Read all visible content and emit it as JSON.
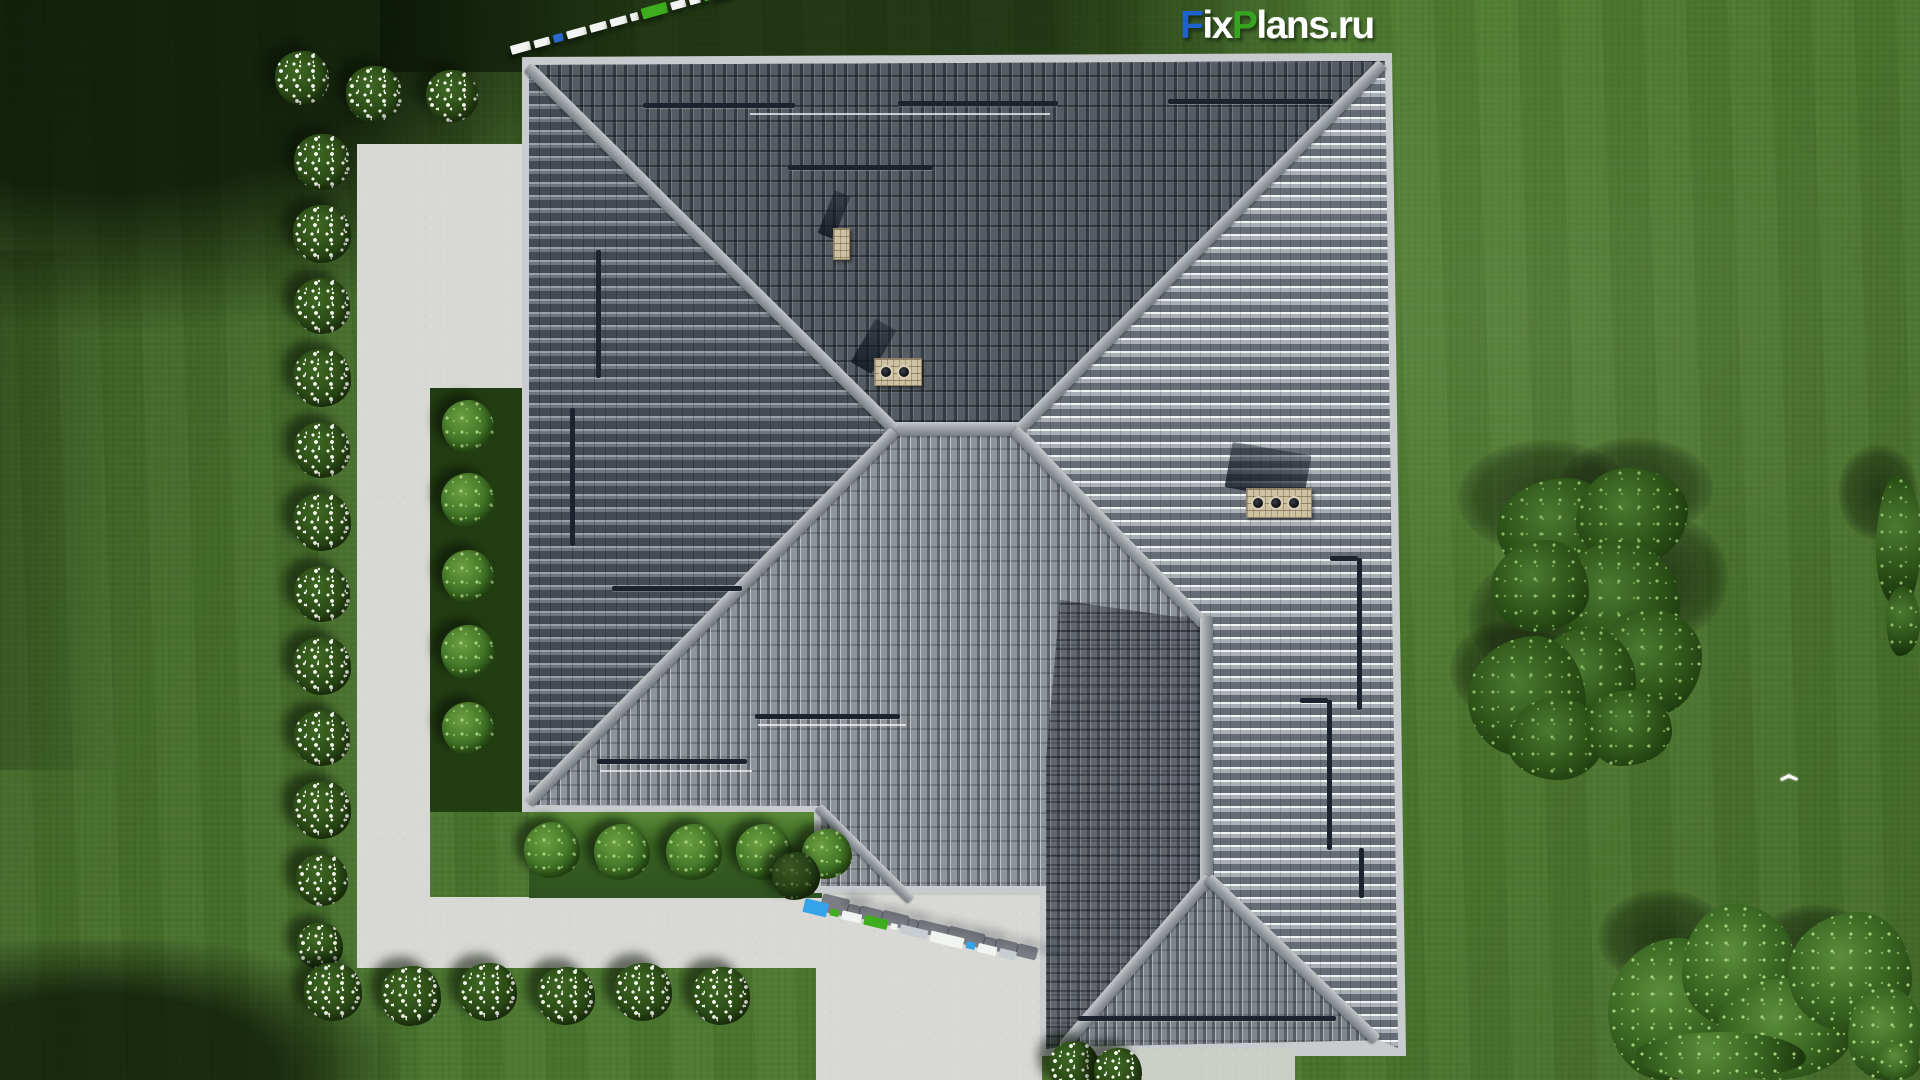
{
  "watermark": {
    "parts": [
      {
        "text": "F",
        "color": "#1e62d0"
      },
      {
        "text": "ix",
        "color": "#ffffff"
      },
      {
        "text": "P",
        "color": "#35a421"
      },
      {
        "text": "lans",
        "color": "#ffffff"
      },
      {
        "text": ".ru",
        "color": "#ffffff"
      }
    ]
  },
  "palette": {
    "grass": "#4a762d",
    "grass_shadow": "#1c350f",
    "concrete": "#d8d8d4",
    "roof_dark": "#40464e",
    "roof_light": "#9aa0a7",
    "ridge": "#a7abaf",
    "brick": "#cfc2a2",
    "accent_blue": "#2a6ad0",
    "accent_cyan": "#35a3e8",
    "accent_green": "#3fae1e",
    "flower_white": "#f6f8f0"
  },
  "garden": {
    "flower_bushes": [
      [
        302,
        78,
        54
      ],
      [
        374,
        94,
        56
      ],
      [
        452,
        96,
        52
      ],
      [
        322,
        162,
        56
      ],
      [
        322,
        234,
        58
      ],
      [
        322,
        306,
        56
      ],
      [
        322,
        378,
        58
      ],
      [
        322,
        450,
        56
      ],
      [
        322,
        522,
        58
      ],
      [
        322,
        594,
        56
      ],
      [
        322,
        666,
        58
      ],
      [
        322,
        738,
        56
      ],
      [
        322,
        810,
        58
      ],
      [
        322,
        880,
        52
      ],
      [
        320,
        946,
        46
      ],
      [
        333,
        992,
        58
      ],
      [
        411,
        996,
        60
      ],
      [
        488,
        992,
        58
      ],
      [
        566,
        996,
        58
      ],
      [
        643,
        992,
        58
      ],
      [
        721,
        996,
        58
      ],
      [
        1074,
        1066,
        50
      ],
      [
        1118,
        1072,
        48
      ]
    ],
    "green_bushes": [
      [
        468,
        426,
        52,
        0
      ],
      [
        468,
        500,
        54,
        0
      ],
      [
        468,
        576,
        52,
        0
      ],
      [
        468,
        652,
        54,
        0
      ],
      [
        468,
        728,
        52,
        0
      ],
      [
        552,
        850,
        56,
        0
      ],
      [
        622,
        852,
        56,
        0
      ],
      [
        694,
        852,
        56,
        0
      ],
      [
        764,
        852,
        56,
        0
      ],
      [
        827,
        854,
        50,
        0
      ],
      [
        796,
        876,
        48,
        1
      ]
    ]
  },
  "trees": {
    "shadows": [
      [
        1458,
        440,
        175,
        115
      ],
      [
        1558,
        438,
        155,
        100
      ],
      [
        1468,
        555,
        150,
        125
      ],
      [
        1598,
        515,
        130,
        125
      ],
      [
        1450,
        620,
        120,
        100
      ],
      [
        1598,
        890,
        130,
        95
      ],
      [
        1755,
        905,
        120,
        85
      ],
      [
        1640,
        935,
        130,
        80
      ],
      [
        1838,
        445,
        80,
        95
      ]
    ],
    "canopies": [
      [
        1497,
        478,
        122,
        100,
        0
      ],
      [
        1576,
        468,
        112,
        96,
        0
      ],
      [
        1556,
        542,
        124,
        118,
        0
      ],
      [
        1491,
        540,
        98,
        92,
        0
      ],
      [
        1598,
        608,
        104,
        108,
        0
      ],
      [
        1538,
        628,
        98,
        98,
        0
      ],
      [
        1468,
        636,
        118,
        120,
        0
      ],
      [
        1508,
        698,
        98,
        82,
        0
      ],
      [
        1586,
        690,
        86,
        76,
        0
      ],
      [
        1608,
        938,
        124,
        142,
        1
      ],
      [
        1682,
        904,
        112,
        124,
        1
      ],
      [
        1718,
        978,
        134,
        102,
        1
      ],
      [
        1788,
        912,
        124,
        118,
        1
      ],
      [
        1848,
        986,
        74,
        94,
        1
      ],
      [
        1636,
        1032,
        170,
        48,
        1
      ],
      [
        1876,
        1040,
        44,
        40,
        1
      ],
      [
        1876,
        476,
        46,
        132,
        0
      ],
      [
        1886,
        586,
        34,
        70,
        0
      ]
    ]
  },
  "strips": [
    {
      "x": 511,
      "y": 44,
      "angle": -15.5,
      "gap": 4,
      "cls": "strip1",
      "pieces": [
        [
          "w",
          20,
          9
        ],
        [
          "w",
          16,
          8
        ],
        [
          "b",
          10,
          8
        ],
        [
          "w",
          20,
          8
        ],
        [
          "w",
          17,
          8
        ],
        [
          "w",
          17,
          8
        ],
        [
          "w",
          8,
          8
        ],
        [
          "g",
          26,
          11
        ],
        [
          "w",
          15,
          8
        ],
        [
          "w",
          11,
          8
        ],
        [
          "g",
          7,
          8
        ],
        [
          "b",
          20,
          13
        ]
      ]
    },
    {
      "x": 804,
      "y": 898,
      "angle": 13.5,
      "gap": 3,
      "cls": "strip2",
      "pieces": [
        [
          "c",
          24,
          14
        ],
        [
          "g",
          9,
          7
        ],
        [
          "w",
          20,
          9
        ],
        [
          "g",
          24,
          10
        ],
        [
          "w",
          7,
          6
        ],
        [
          "wd",
          28,
          9
        ],
        [
          "w",
          34,
          11
        ],
        [
          "c",
          9,
          7
        ],
        [
          "w",
          19,
          9
        ],
        [
          "wd",
          17,
          9
        ]
      ]
    }
  ],
  "roof": {
    "snow_bars_h": [
      [
        643,
        103,
        152
      ],
      [
        898,
        101,
        160
      ],
      [
        1168,
        99,
        165
      ],
      [
        788,
        165,
        145
      ],
      [
        612,
        586,
        130
      ],
      [
        755,
        714,
        145
      ],
      [
        597,
        759,
        150
      ],
      [
        1078,
        1016,
        258
      ],
      [
        1330,
        556,
        28
      ],
      [
        1300,
        698,
        28
      ]
    ],
    "snow_bars_v": [
      [
        596,
        250,
        128
      ],
      [
        570,
        408,
        138
      ],
      [
        1357,
        558,
        152
      ],
      [
        1327,
        700,
        150
      ],
      [
        1359,
        848,
        50
      ]
    ],
    "white_lines": [
      [
        750,
        113,
        300
      ],
      [
        600,
        770,
        152
      ],
      [
        758,
        724,
        148
      ]
    ],
    "chimneys": [
      {
        "x": 833,
        "y": 228,
        "w": 17,
        "h": 32,
        "pots": 0
      },
      {
        "x": 874,
        "y": 358,
        "w": 48,
        "h": 28,
        "pots": 2
      },
      {
        "x": 1246,
        "y": 488,
        "w": 66,
        "h": 30,
        "pots": 3
      }
    ],
    "chimney_shadows": [
      {
        "x": 817,
        "y": 190,
        "w": 17,
        "h": 46,
        "a": 22
      },
      {
        "x": 849,
        "y": 318,
        "w": 24,
        "h": 50,
        "a": 30
      },
      {
        "x": 1224,
        "y": 448,
        "w": 80,
        "h": 46,
        "a": 10
      }
    ]
  },
  "bird": {
    "x": 1780,
    "y": 772
  }
}
